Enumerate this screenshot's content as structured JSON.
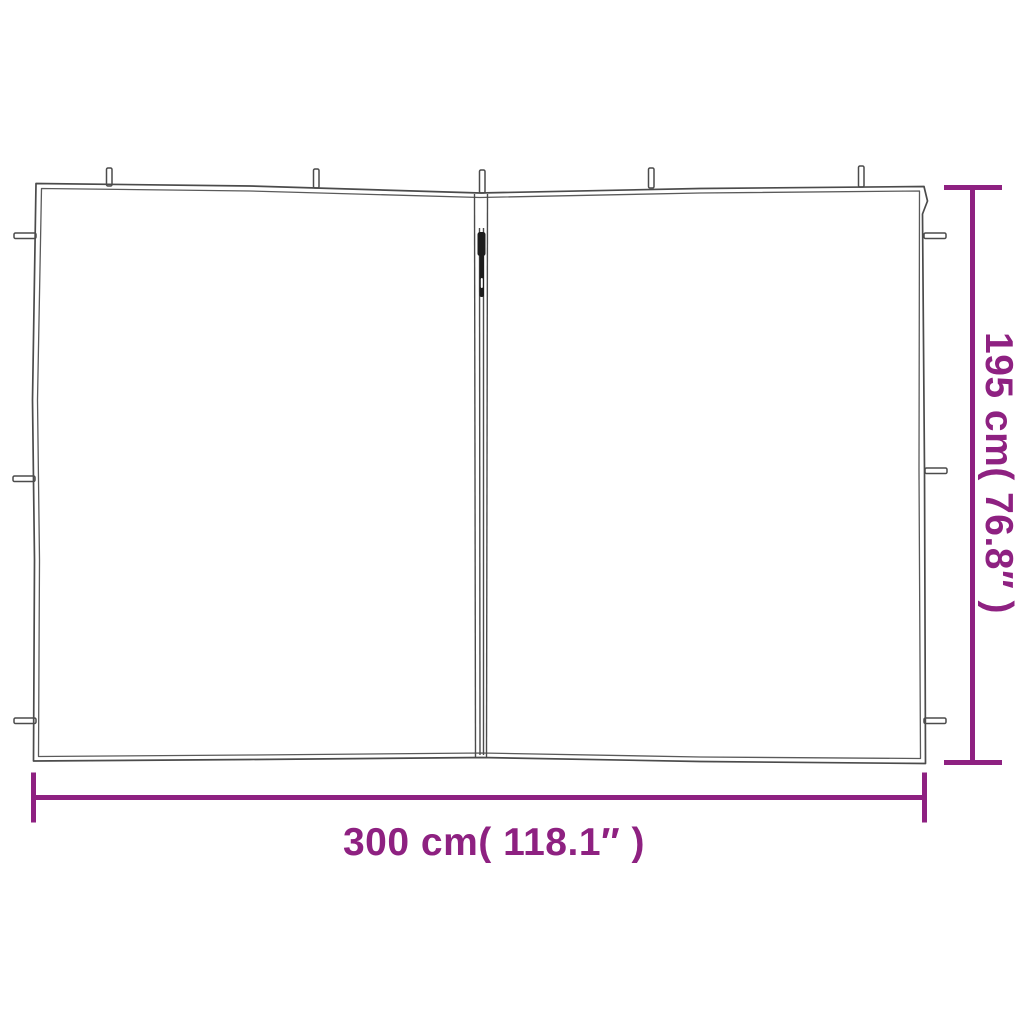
{
  "colors": {
    "accent": "#8e2181",
    "line": "#4b4b4b",
    "hem_line": "#5a5a5a",
    "zipper_dark": "#1c1c1c",
    "background": "#ffffff"
  },
  "dimensions": {
    "width_label": "300 cm( 118.1″ )",
    "height_label": "195 cm( 76.8″ )"
  },
  "drawing": {
    "subject": "gazebo-sidewall-panel-with-center-zipper",
    "top_loop_count": 5,
    "left_tie_count": 3,
    "right_tie_count": 3
  }
}
